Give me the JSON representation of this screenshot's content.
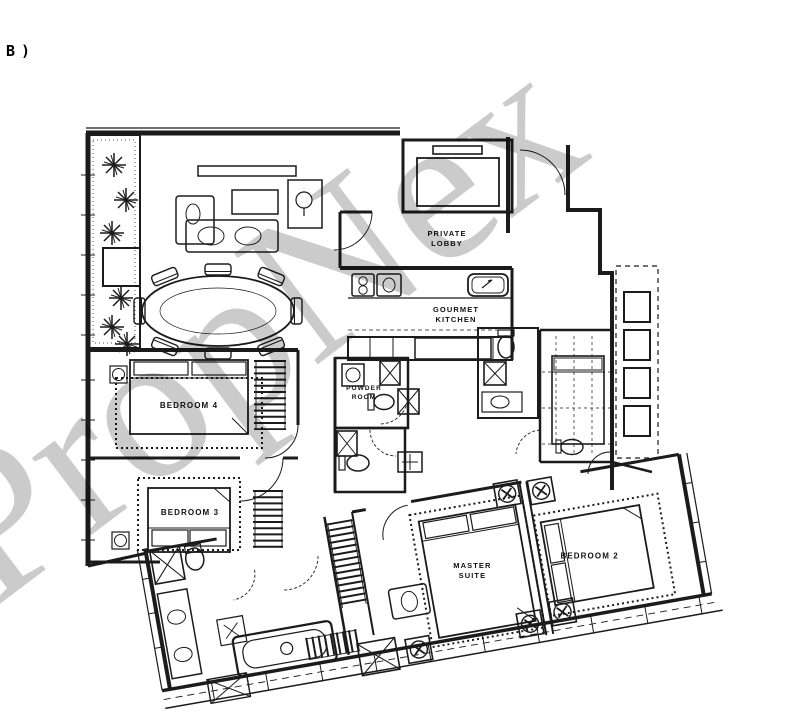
{
  "page_label": "B)",
  "watermark": {
    "text": "PropNex",
    "color": "#c8c8c8"
  },
  "plan": {
    "line_color": "#1b1b1b",
    "background": "#ffffff",
    "rooms": {
      "private_lobby": {
        "line1": "PRIVATE",
        "line2": "LOBBY"
      },
      "gourmet_kitchen": {
        "line1": "GOURMET",
        "line2": "KITCHEN"
      },
      "powder_room": {
        "line1": "POWDER",
        "line2": "ROOM"
      },
      "bedroom4": {
        "line1": "BEDROOM 4"
      },
      "bedroom3": {
        "line1": "BEDROOM 3"
      },
      "bedroom2": {
        "line1": "BEDROOM 2"
      },
      "master_suite": {
        "line1": "MASTER",
        "line2": "SUITE"
      }
    },
    "fixtures": [
      "private-lift",
      "balcony-planters",
      "dining-table-8-seats",
      "sofa-set",
      "kitchen-hob",
      "kitchen-sink",
      "kitchen-island-hatched",
      "shower-trays",
      "toilets",
      "basins",
      "bathtub",
      "walk-in-wardrobe-hangers",
      "beds",
      "ceiling-fans",
      "ac-ledge-boxes",
      "balcony-ledge"
    ]
  }
}
